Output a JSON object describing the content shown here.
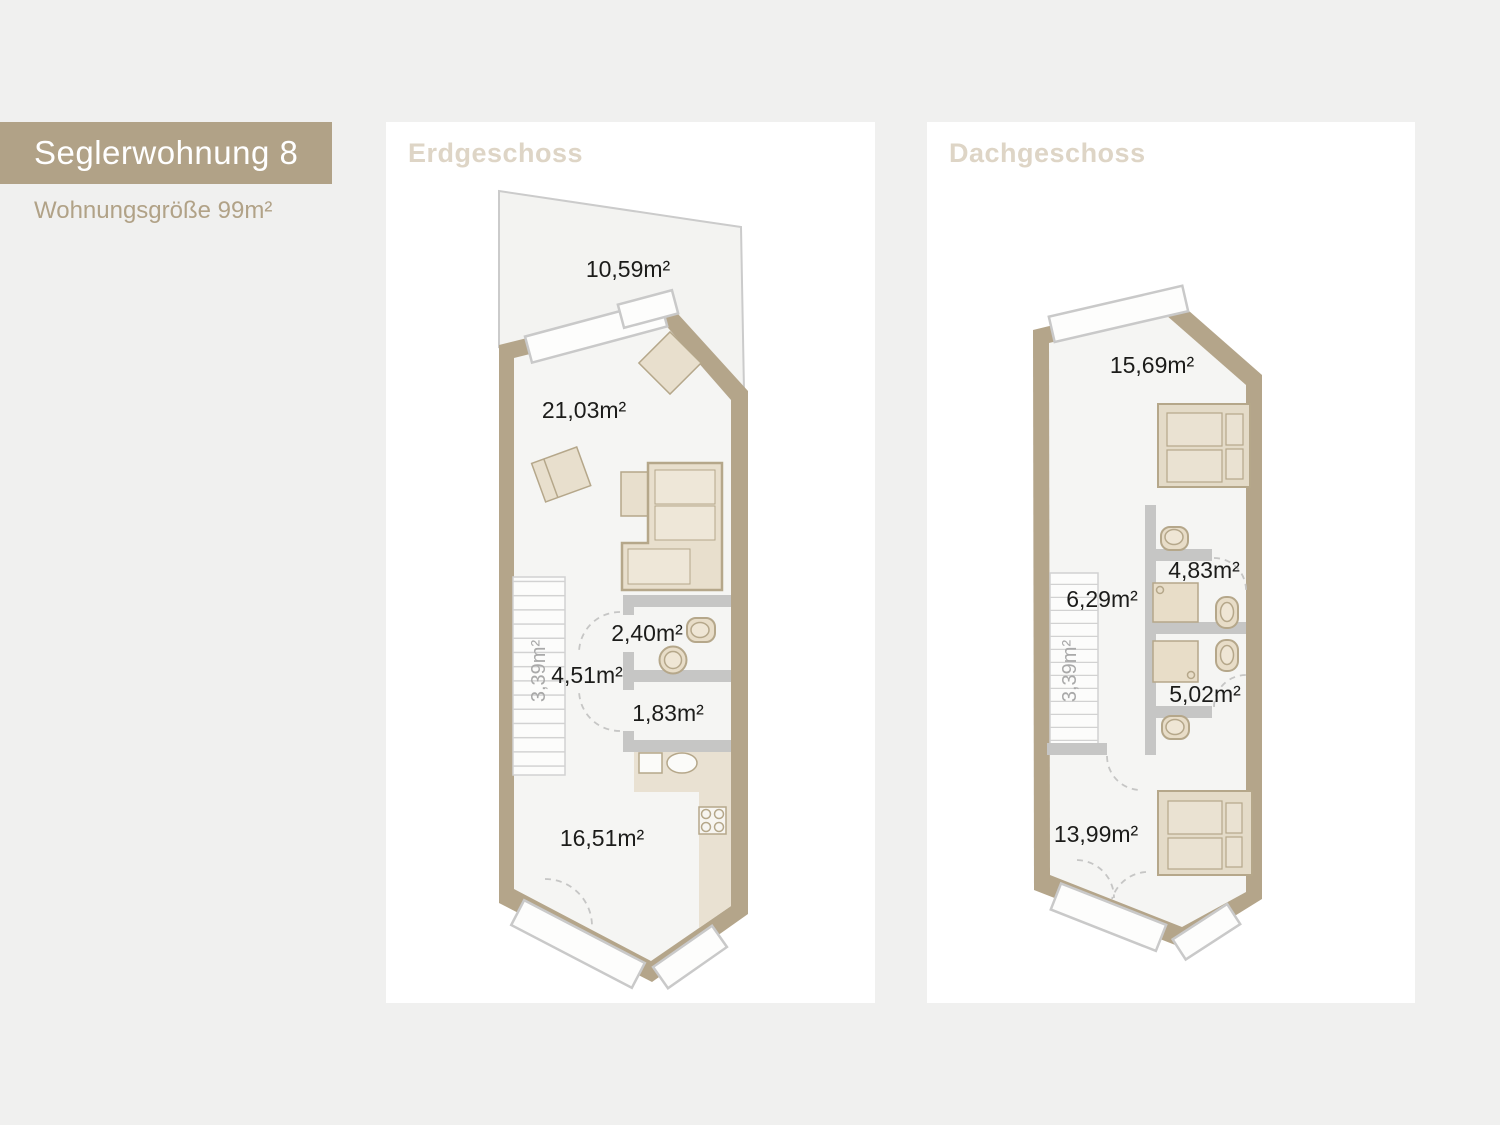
{
  "header": {
    "title": "Seglerwohnung 8",
    "subtitle": "Wohnungsgröße 99m²"
  },
  "panels": {
    "erdgeschoss": {
      "title": "Erdgeschoss",
      "areas": {
        "terrace": "10,59m²",
        "living": "21,03m²",
        "bath": "2,40m²",
        "hall": "4,51m²",
        "wc": "1,83m²",
        "stairs": "3,39m²",
        "room": "16,51m²"
      }
    },
    "dachgeschoss": {
      "title": "Dachgeschoss",
      "areas": {
        "top_room": "15,69m²",
        "bath_top": "4,83m²",
        "landing": "6,29m²",
        "stairs": "3,39m²",
        "bath_bottom": "5,02m²",
        "bottom_room": "13,99m²"
      }
    }
  },
  "colors": {
    "background": "#f0f0ef",
    "accent_tan": "#b1a287",
    "wall_tan": "#b4a58a",
    "panel_title": "#ded5c6",
    "floor": "#f5f5f3",
    "terrace_fill": "#f3f3f1",
    "interior_wall": "#c6c6c5",
    "furniture_fill": "#e8dfcd",
    "kitchen_fill": "#e9e1d2",
    "label_text": "#1c1c1a",
    "stair_label": "#a9a9a9"
  }
}
